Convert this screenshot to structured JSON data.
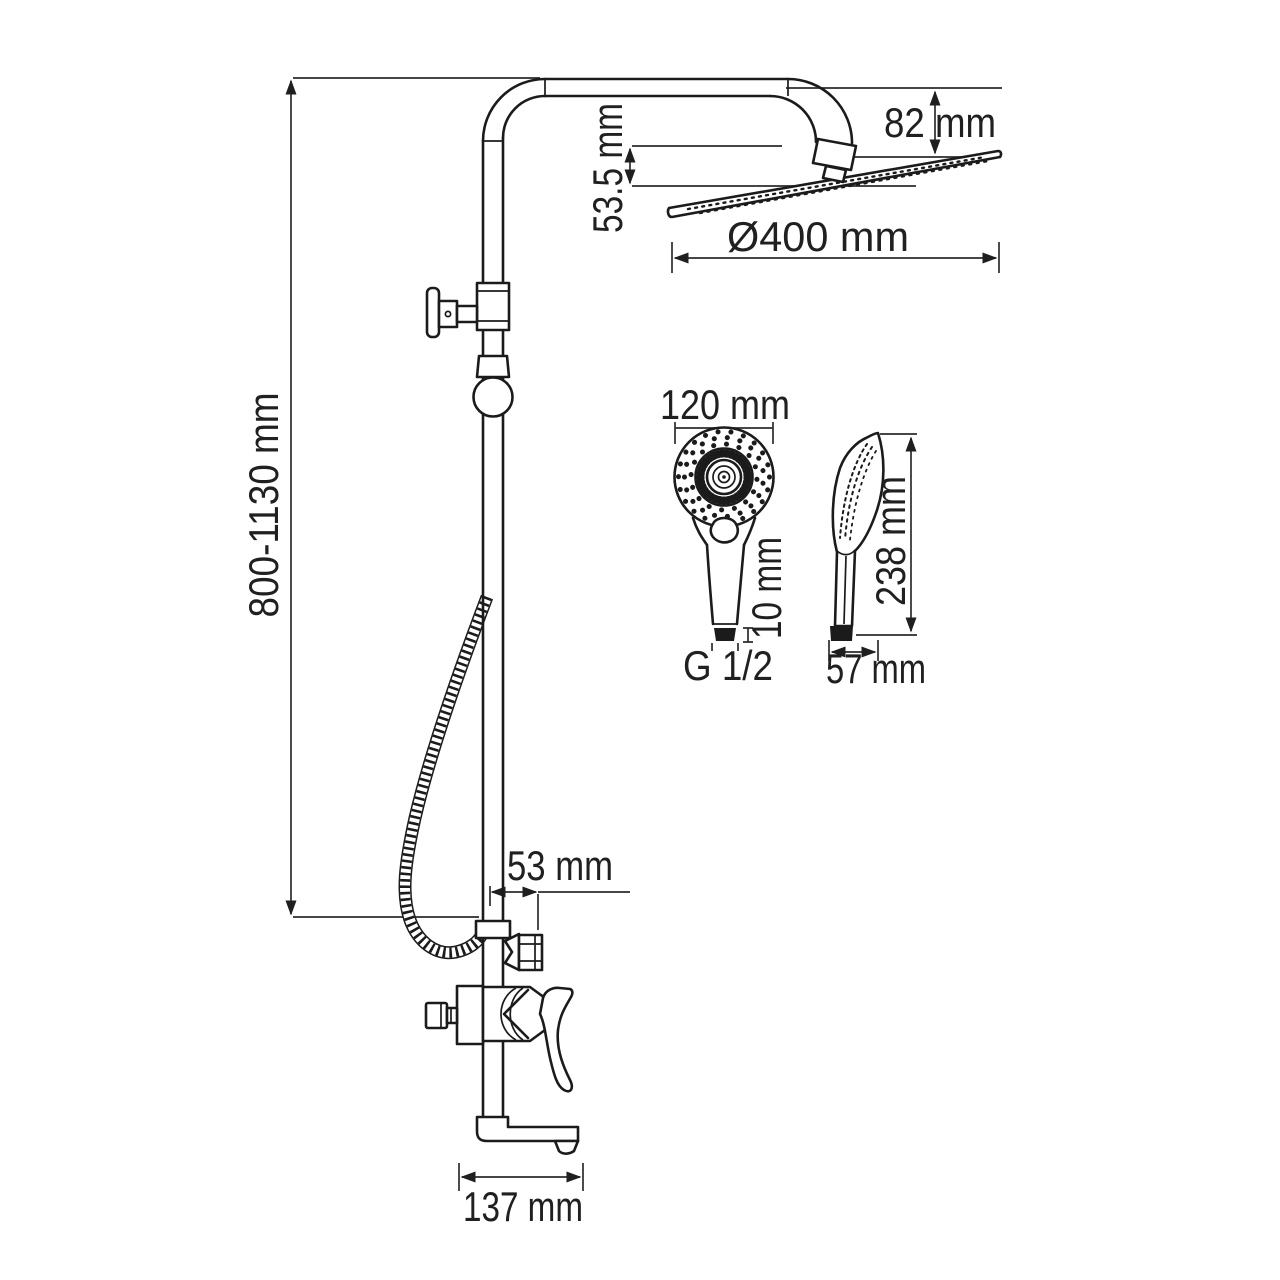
{
  "colors": {
    "background": "#ffffff",
    "line": "#1b1b1b",
    "dimension_line": "#2c2c2c",
    "text": "#202020"
  },
  "diagram": {
    "type": "shower-system-dimension-drawing",
    "labels": {
      "height_range": "800-1130 mm",
      "head_drop": "82 mm",
      "head_connector_height": "53.5 mm",
      "head_diameter": "Ø400 mm",
      "handshower_diameter": "120 mm",
      "handshower_thread_length": "10 mm",
      "handshower_thread": "G 1/2",
      "handshower_length": "238 mm",
      "handshower_depth": "57 mm",
      "outlet_offset": "53 mm",
      "spout_length": "137 mm"
    }
  }
}
